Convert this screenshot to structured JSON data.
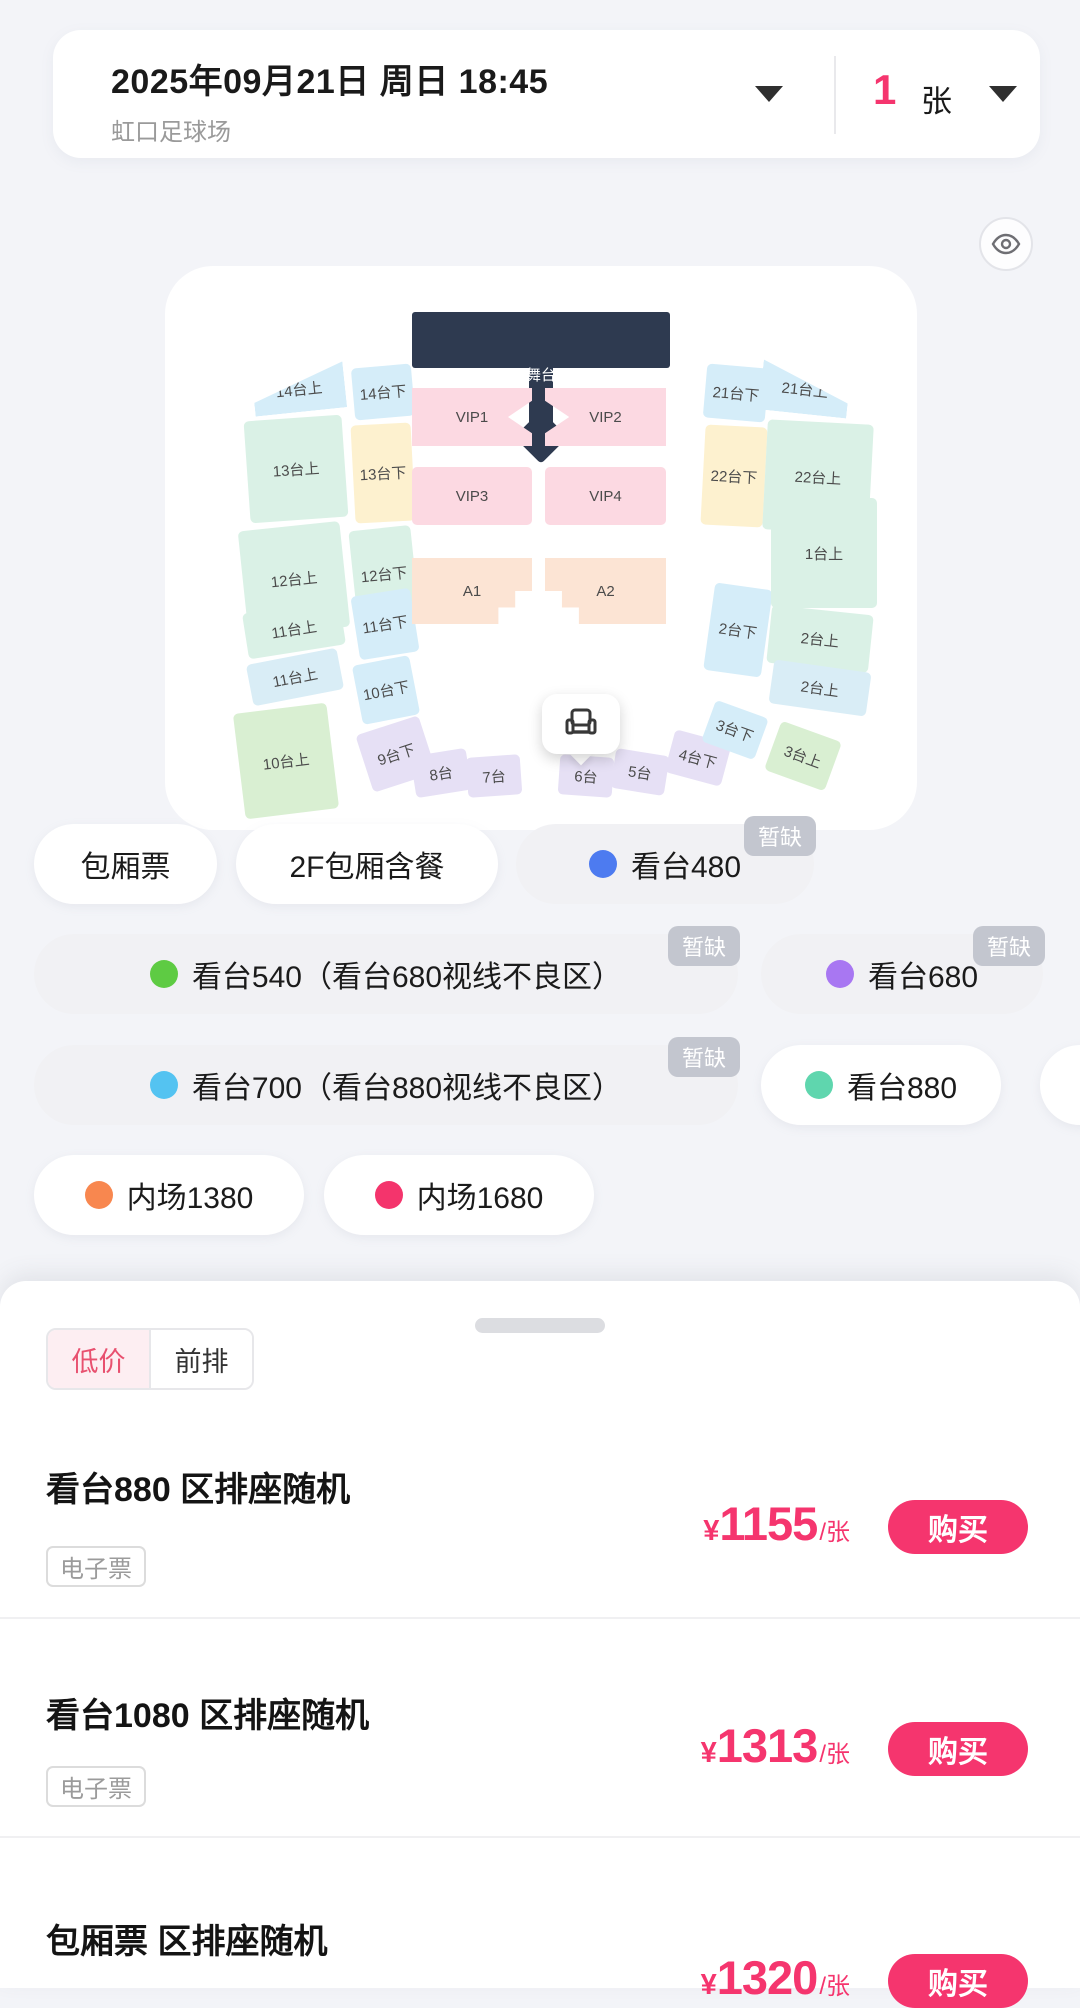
{
  "header": {
    "date": "2025年09月21日 周日 18:45",
    "venue": "虹口足球场",
    "quantity": "1",
    "unit": "张"
  },
  "map": {
    "stage_label": "舞台",
    "sections": [
      {
        "id": "s14u",
        "label": "14台上",
        "color": "#d5edf9"
      },
      {
        "id": "s13u",
        "label": "13台上",
        "color": "#daf1e6"
      },
      {
        "id": "s12u",
        "label": "12台上",
        "color": "#daf1e6"
      },
      {
        "id": "s11u",
        "label": "11台上",
        "color": "#daf1e6"
      },
      {
        "id": "s11u2",
        "label": "11台上",
        "color": "#d9edf6"
      },
      {
        "id": "s10u",
        "label": "10台上",
        "color": "#d9efd2"
      },
      {
        "id": "s14d",
        "label": "14台下",
        "color": "#d5edf9"
      },
      {
        "id": "s13d",
        "label": "13台下",
        "color": "#fdf1cf"
      },
      {
        "id": "s12d",
        "label": "12台下",
        "color": "#daf1e6"
      },
      {
        "id": "s11d",
        "label": "11台下",
        "color": "#d5edf9"
      },
      {
        "id": "s10d",
        "label": "10台下",
        "color": "#d5edf9"
      },
      {
        "id": "s9d",
        "label": "9台下",
        "color": "#e6e0f5"
      },
      {
        "id": "s8",
        "label": "8台",
        "color": "#e6e0f5"
      },
      {
        "id": "s7",
        "label": "7台",
        "color": "#e6e0f5"
      },
      {
        "id": "s6",
        "label": "6台",
        "color": "#e6e0f5"
      },
      {
        "id": "s5",
        "label": "5台",
        "color": "#e6e0f5"
      },
      {
        "id": "s4d",
        "label": "4台下",
        "color": "#e6e0f5"
      },
      {
        "id": "s3d",
        "label": "3台下",
        "color": "#d5edf9"
      },
      {
        "id": "s3u",
        "label": "3台上",
        "color": "#d9efd2"
      },
      {
        "id": "s21d",
        "label": "21台下",
        "color": "#d5edf9"
      },
      {
        "id": "s22d",
        "label": "22台下",
        "color": "#fdf1cf"
      },
      {
        "id": "s2d",
        "label": "2台下",
        "color": "#d5edf9"
      },
      {
        "id": "s21u",
        "label": "21台上",
        "color": "#d5edf9"
      },
      {
        "id": "s22u",
        "label": "22台上",
        "color": "#daf1e6"
      },
      {
        "id": "s1u",
        "label": "1台上",
        "color": "#daf1e6"
      },
      {
        "id": "s2u",
        "label": "2台上",
        "color": "#daf1e6"
      },
      {
        "id": "s2u2",
        "label": "2台上",
        "color": "#d9edf6"
      },
      {
        "id": "vip1",
        "label": "VIP1",
        "color": "#fcd9e2"
      },
      {
        "id": "vip2",
        "label": "VIP2",
        "color": "#fcd9e2"
      },
      {
        "id": "vip3",
        "label": "VIP3",
        "color": "#fcd9e2"
      },
      {
        "id": "vip4",
        "label": "VIP4",
        "color": "#fcd9e2"
      },
      {
        "id": "a1",
        "label": "A1",
        "color": "#fce4d4"
      },
      {
        "id": "a2",
        "label": "A2",
        "color": "#fce4d4"
      }
    ]
  },
  "categories": [
    {
      "id": "r1c1",
      "label": "包厢票",
      "dot": null,
      "badge": null,
      "disabled": false
    },
    {
      "id": "r1c2",
      "label": "2F包厢含餐",
      "dot": null,
      "badge": null,
      "disabled": false
    },
    {
      "id": "r1c3",
      "label": "看台480",
      "dot": "#4d7bf0",
      "badge": "暂缺",
      "disabled": true
    },
    {
      "id": "r2c1",
      "label": "看台540（看台680视线不良区）",
      "dot": "#5ecb43",
      "badge": "暂缺",
      "disabled": true
    },
    {
      "id": "r2c2",
      "label": "看台680",
      "dot": "#a877f2",
      "badge": "暂缺",
      "disabled": true
    },
    {
      "id": "r3c1",
      "label": "看台700（看台880视线不良区）",
      "dot": "#54c3f1",
      "badge": "暂缺",
      "disabled": true
    },
    {
      "id": "r3c2",
      "label": "看台880",
      "dot": "#5fd6ae",
      "badge": null,
      "disabled": false
    },
    {
      "id": "r3c3",
      "label": "",
      "dot": "#fac43c",
      "badge": null,
      "disabled": false
    },
    {
      "id": "r4c1",
      "label": "内场1380",
      "dot": "#f8874f",
      "badge": null,
      "disabled": false
    },
    {
      "id": "r4c2",
      "label": "内场1680",
      "dot": "#f4346c",
      "badge": null,
      "disabled": false
    }
  ],
  "sheet": {
    "tabs": [
      {
        "label": "低价",
        "active": true
      },
      {
        "label": "前排",
        "active": false
      }
    ],
    "listings": [
      {
        "title": "看台880 区排座随机",
        "tag": "电子票",
        "currency": "¥",
        "price": "1155",
        "per": "/张",
        "buy": "购买"
      },
      {
        "title": "看台1080 区排座随机",
        "tag": "电子票",
        "currency": "¥",
        "price": "1313",
        "per": "/张",
        "buy": "购买"
      },
      {
        "title": "包厢票 区排座随机",
        "tag": null,
        "currency": "¥",
        "price": "1320",
        "per": "/张",
        "buy": "购买"
      }
    ]
  },
  "colors": {
    "accent": "#f5356e",
    "stage": "#2e3a50",
    "badge_bg": "#c3c6cf",
    "page_bg": "#f3f4f8"
  }
}
